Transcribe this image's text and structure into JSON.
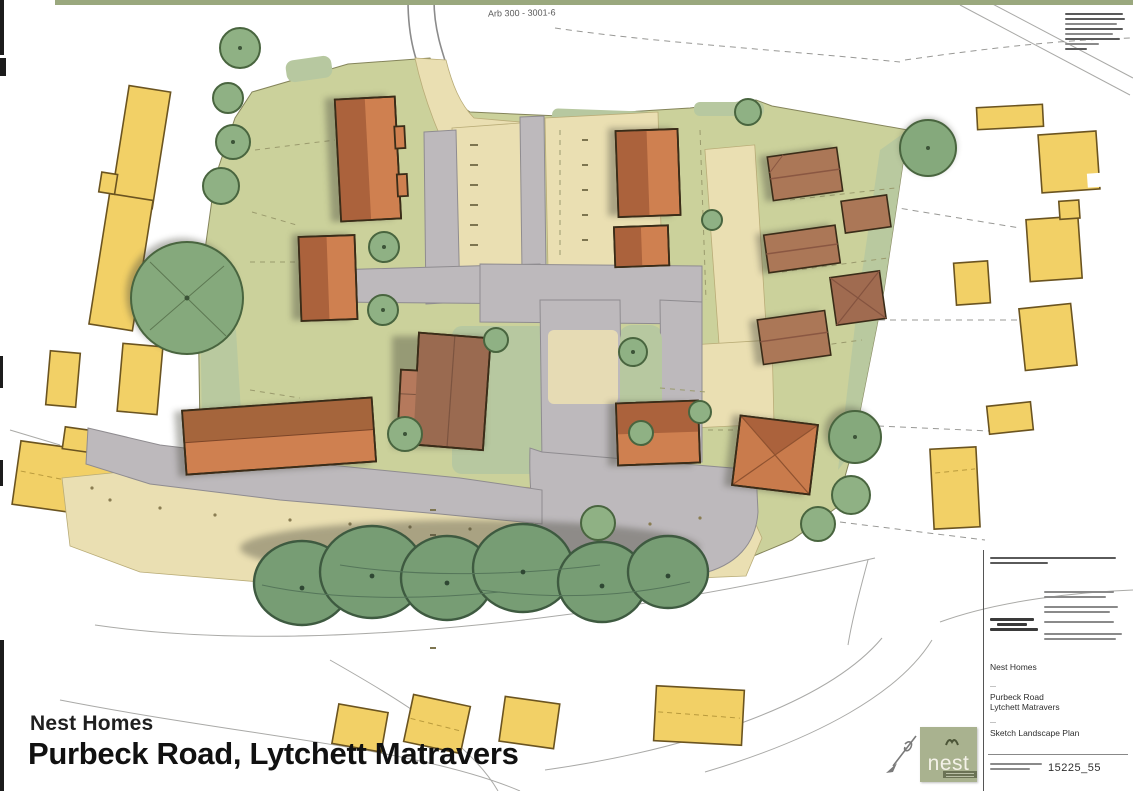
{
  "titles": {
    "client": "Nest Homes",
    "project": "Purbeck Road, Lytchett Matravers"
  },
  "top_annotation": {
    "text": "Arb 300 - 3001-6"
  },
  "title_block": {
    "client": "Nest Homes",
    "job_line1": "Purbeck Road",
    "job_line2": "Lytchett Matravers",
    "drawing": "Sketch Landscape Plan",
    "number": "15225_55"
  },
  "logo": {
    "text": "nest"
  },
  "plan": {
    "palette": {
      "site_grass": "#cbd19b",
      "verge_green": "#b7c8a0",
      "court_buff": "#eadfb2",
      "road_grey": "#bdb9bc",
      "proposed_orange": "#cf8050",
      "proposed_roof": "#ab623c",
      "ne_brown": "#ab7757",
      "ne_brown_dark": "#95604a",
      "existing_yellow": "#f2d express066",
      "existing_yellow_fix": "#f2d066",
      "tree_green": "#8fb184",
      "tree_dark": "#49653f",
      "big_tree_green": "#779d74",
      "outline_dark": "#3a2c18",
      "logo_sage": "#a9b28f"
    },
    "legend_note": "hand-drawn sketch landscape plan; proposed dwellings orange/brown, existing buildings yellow, roads grey, trees green"
  }
}
